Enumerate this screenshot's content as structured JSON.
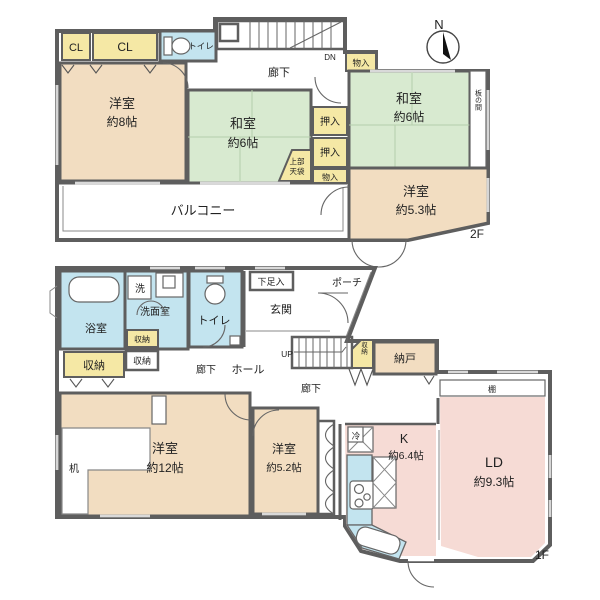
{
  "floor2": {
    "floor_label": "2F",
    "compass_n": "N",
    "cl1": "CL",
    "cl2": "CL",
    "toilet": "トイレ",
    "stairs_dn": "DN",
    "corridor": "廊下",
    "monoire_hall": "物入",
    "yoshitsu8": {
      "name": "洋室",
      "size": "約8帖"
    },
    "washitsu_center": {
      "name": "和室",
      "size": "約6帖"
    },
    "tenbukuro_line1": "上部",
    "tenbukuro_line2": "天袋",
    "oshiire1": "押入",
    "oshiire2": "押入",
    "monoire_small": "物入",
    "washitsu_east": {
      "name": "和室",
      "size": "約6帖"
    },
    "itanoma": "板の間",
    "yoshitsu53": {
      "name": "洋室",
      "size": "約5.3帖"
    },
    "balcony": "バルコニー"
  },
  "floor1": {
    "floor_label": "1F",
    "bath": "浴室",
    "washer": "洗",
    "senmen": "洗面室",
    "toilet": "トイレ",
    "shuno_senmen": "収納",
    "shuno_left": "収納",
    "shuno_mid": "収納",
    "gesokuire": "下足入",
    "genkan": "玄関",
    "porch": "ポーチ",
    "hall": "ホール",
    "corridor_west": "廊下",
    "corridor_center": "廊下",
    "stairs_up": "UP",
    "shuno_stairs": "収納",
    "nando": "納戸",
    "yoshitsu12": {
      "name": "洋室",
      "size": "約12帖"
    },
    "desk": "机",
    "yoshitsu52": {
      "name": "洋室",
      "size": "約5.2帖"
    },
    "fridge": "冷",
    "kitchen": {
      "name": "K",
      "size": "約6.4帖"
    },
    "shelf": "棚",
    "ld": {
      "name": "LD",
      "size": "約9.3帖"
    }
  },
  "colors": {
    "wall": "#5e5e5e",
    "room_tan": "#f2ddc1",
    "room_green": "#d8ead0",
    "room_yellow": "#f5e8a5",
    "room_blue": "#c3e4ef",
    "room_pink": "#f6dbd5"
  }
}
